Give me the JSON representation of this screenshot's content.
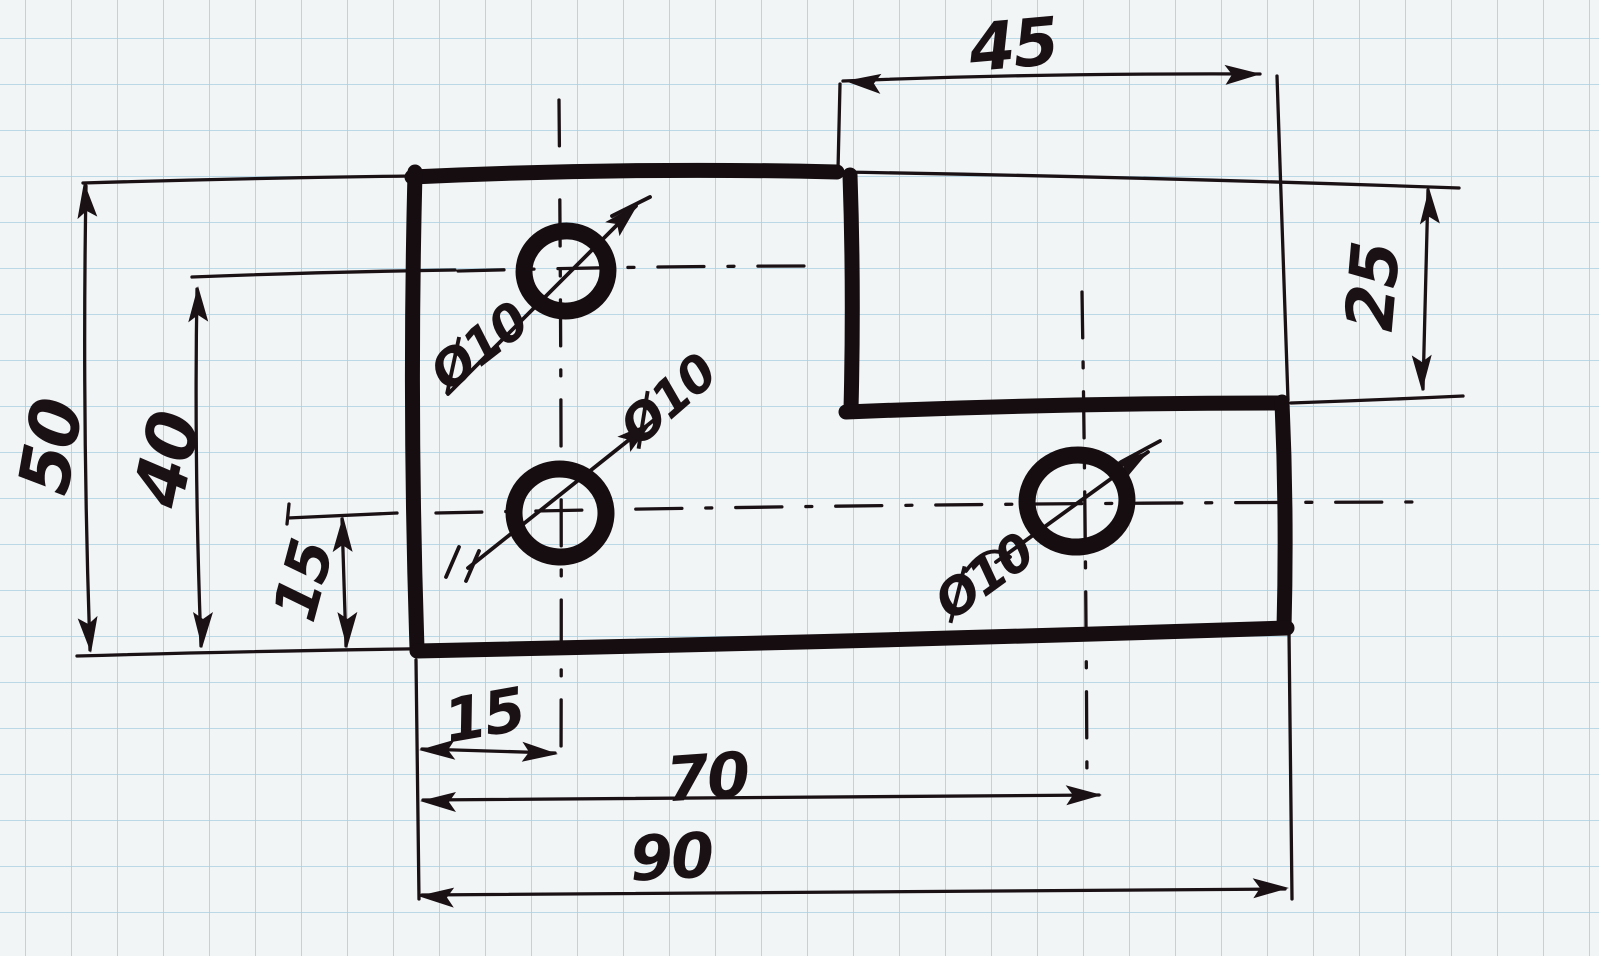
{
  "colors": {
    "paper": "#f2f5f6",
    "grid": "#a8cfe0",
    "ink": "#1a1115"
  },
  "sketch": {
    "kind": "hand-drawn dimensioned part sketch on squared graph paper"
  },
  "dimensions": [
    {
      "label": "45",
      "orientation": "horizontal",
      "location": "top",
      "measures": "width of upper-right step/notch"
    },
    {
      "label": "25",
      "orientation": "vertical",
      "location": "right",
      "measures": "top edge down to step edge"
    },
    {
      "label": "50",
      "orientation": "vertical",
      "location": "left",
      "measures": "overall part height"
    },
    {
      "label": "40",
      "orientation": "vertical",
      "location": "left",
      "measures": "upper hole center to bottom edge"
    },
    {
      "label": "15",
      "orientation": "vertical",
      "location": "left",
      "measures": "middle hole center to bottom edge"
    },
    {
      "label": "15",
      "orientation": "horizontal",
      "location": "bottom",
      "measures": "left edge to hole centerline"
    },
    {
      "label": "70",
      "orientation": "horizontal",
      "location": "bottom",
      "measures": "left edge to right hole center"
    },
    {
      "label": "90",
      "orientation": "horizontal",
      "location": "bottom",
      "measures": "overall part width"
    }
  ],
  "holes": {
    "count": 3,
    "items": [
      {
        "label": "Ø10",
        "position": "upper left"
      },
      {
        "label": "Ø10",
        "position": "middle left"
      },
      {
        "label": "Ø10",
        "position": "middle right"
      }
    ]
  }
}
